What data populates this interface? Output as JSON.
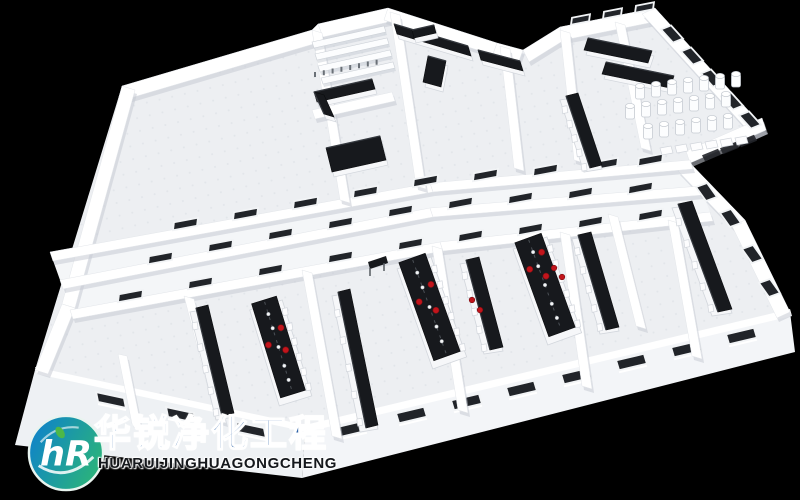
{
  "scene": {
    "description": "3D isometric rendering of a laboratory cleanroom floor plan viewed from above on a black background",
    "background_color": "#000000",
    "rooms": [
      "open plan room",
      "shelving storage room",
      "room with L-shaped counter",
      "prep room with island counter",
      "meeting room with two tables",
      "gas cylinder storage room",
      "double corridor with interior windows",
      "three laboratories with long island benches and red stools",
      "side rooms with wall benches"
    ],
    "palette": {
      "floor": "#edeff2",
      "floor_dot": "#dfe3e8",
      "corridor": "#f4f6f8",
      "wall": "#ffffff",
      "wall_shade": "#c6cbd3",
      "band_l": "#eef1f4",
      "band_r": "#f3f5f8",
      "bench_top": "#17191d",
      "bench_edge": "#35393f",
      "bench_base": "#f6f7f9",
      "base_line": "#d2d6dc",
      "window_glass": "#212429",
      "window_frame": "#f2f4f6",
      "accent_red": "#c2151c",
      "accent_red_dark": "#7a0d11",
      "white_item": "#f4f5f6"
    }
  },
  "logo": {
    "chinese_name": "华锐净化工程",
    "latin_name": "HUARUIJINGHUAGONGCHENG",
    "mark_letters": "hR",
    "mark_color_left": "#0f83c9",
    "mark_color_right": "#2cb577",
    "mark_ring": "#e8f4ef",
    "leaf_color": "#4db848",
    "chinese_color": "#2f63a8",
    "latin_color": "#15181c"
  }
}
